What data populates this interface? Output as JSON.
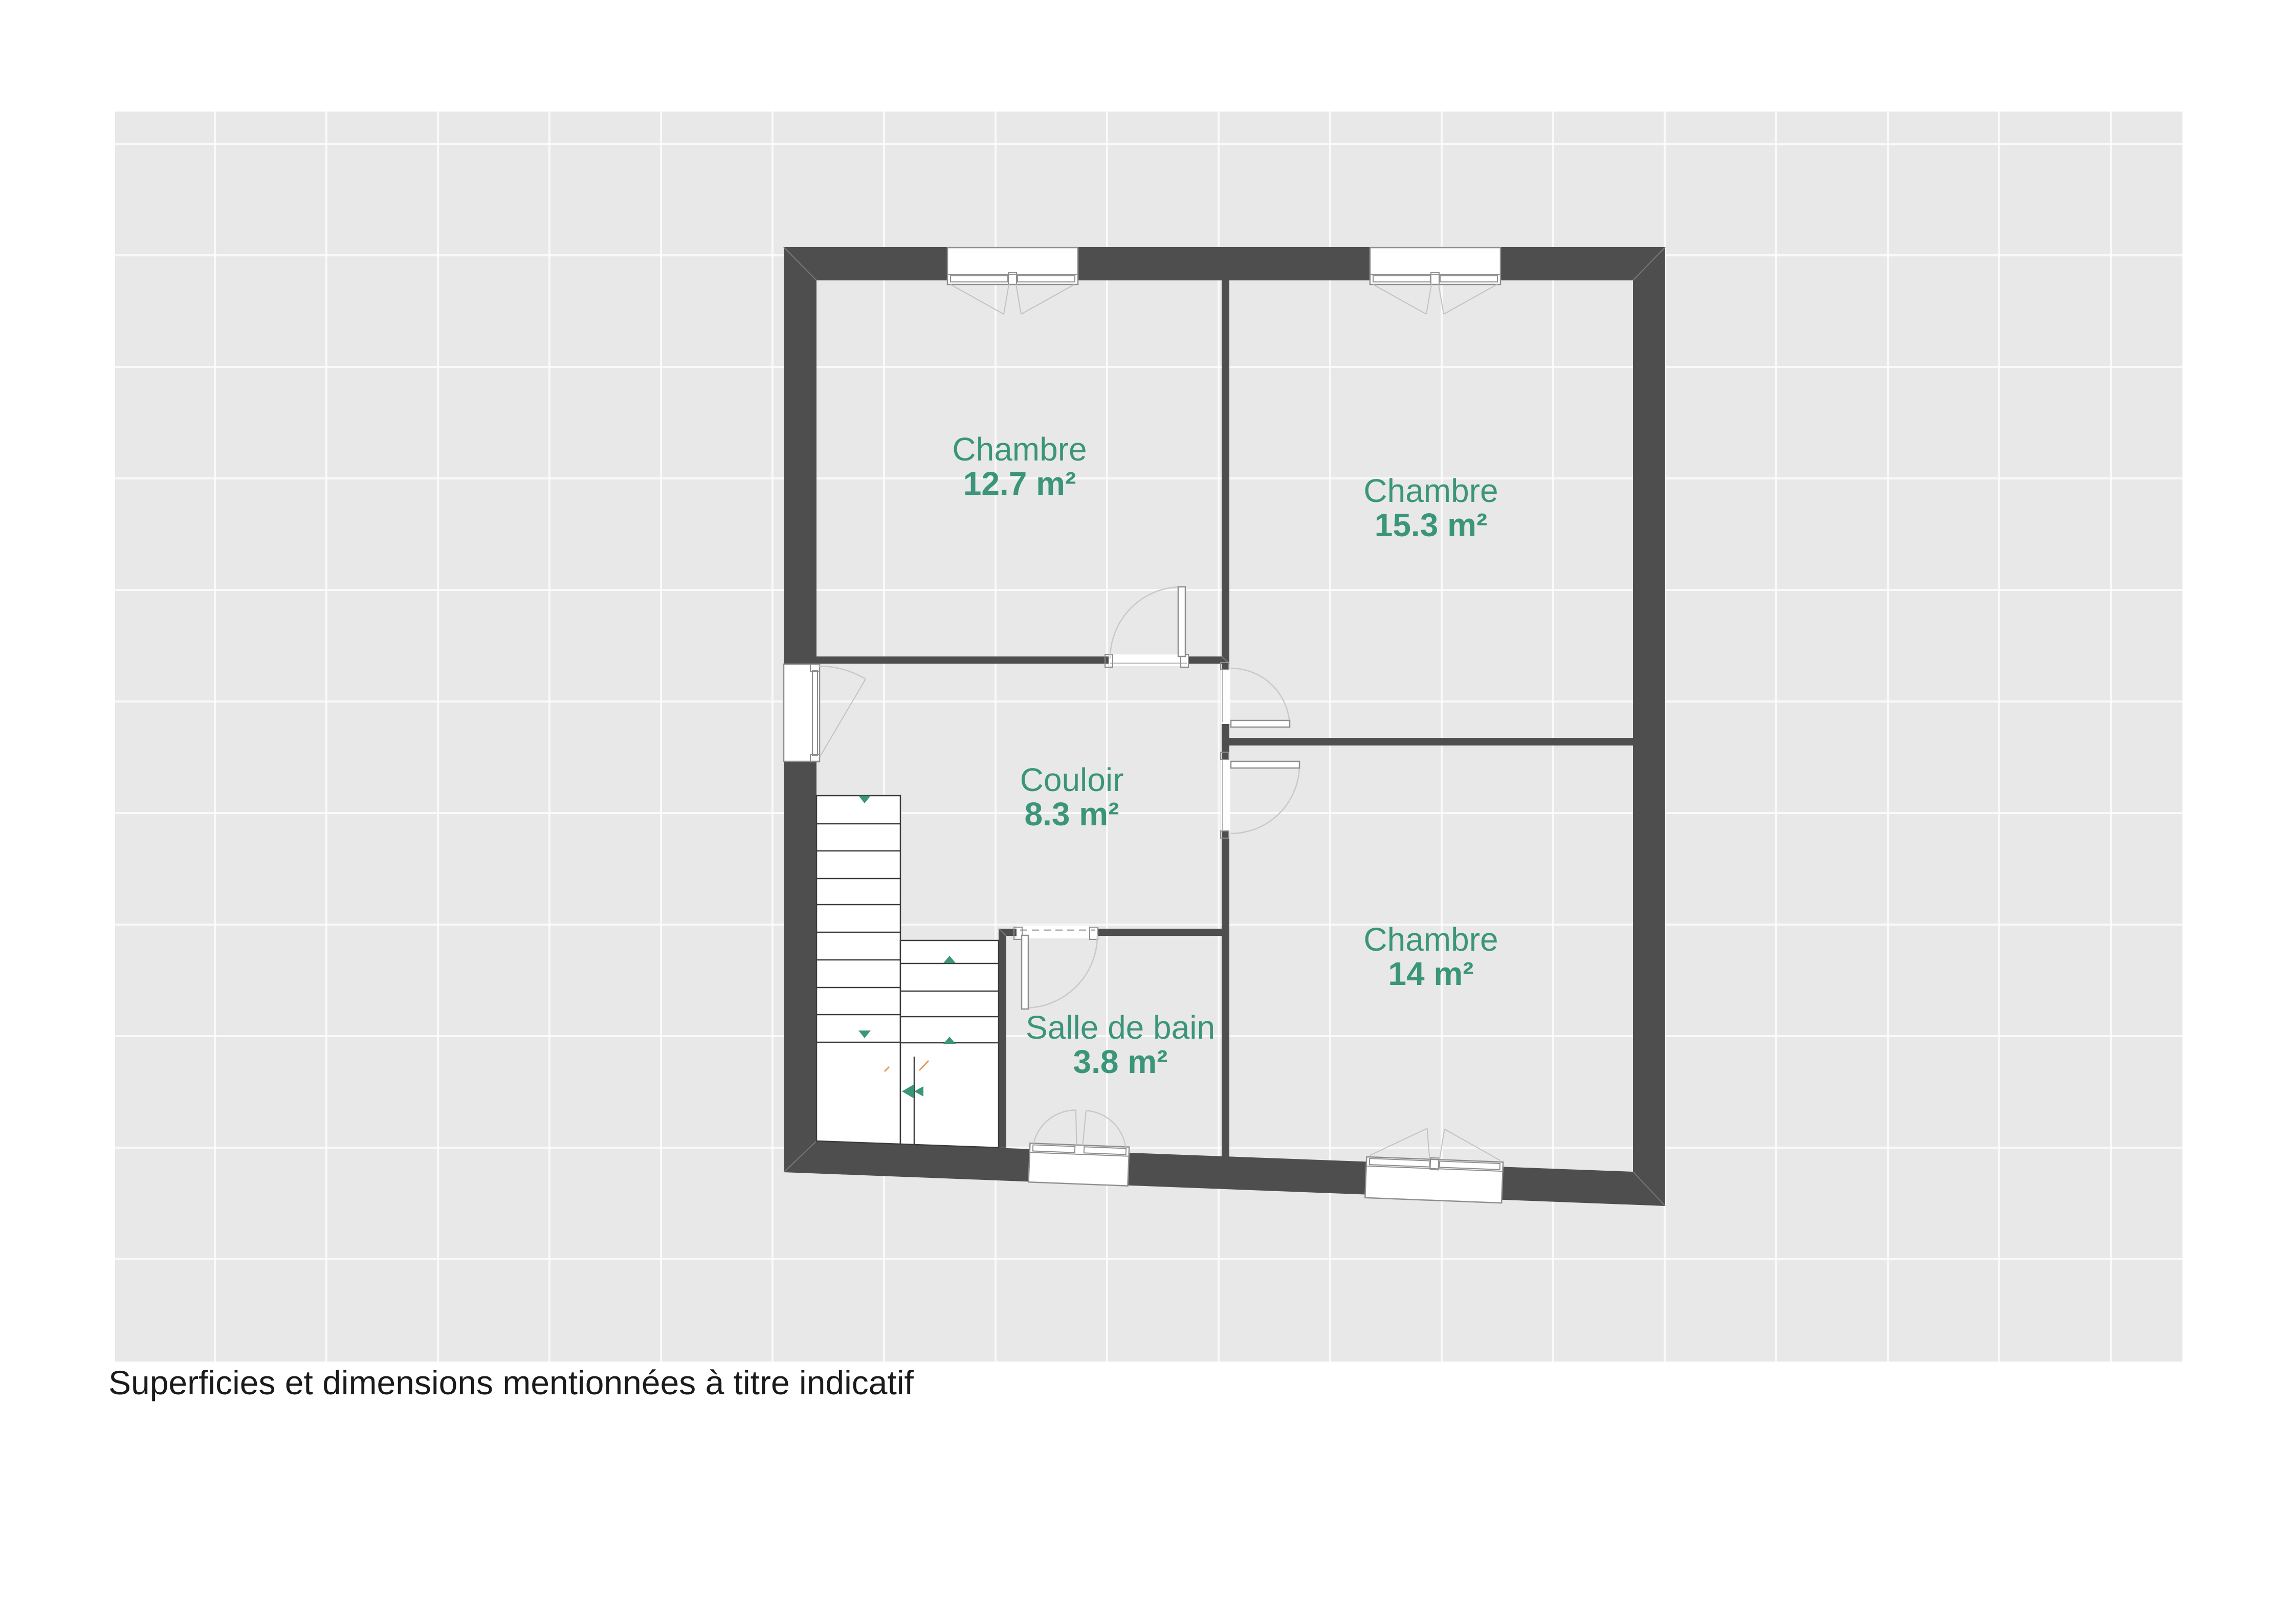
{
  "plan": {
    "caption": "Superficies et dimensions mentionnées à titre indicatif",
    "rooms": [
      {
        "name": "Chambre",
        "area": "12.7 m²"
      },
      {
        "name": "Chambre",
        "area": "15.3 m²"
      },
      {
        "name": "Couloir",
        "area": "8.3 m²"
      },
      {
        "name": "Chambre",
        "area": "14 m²"
      },
      {
        "name": "Salle de bain",
        "area": "3.8 m²"
      }
    ]
  },
  "colors": {
    "wall": "#4e4e4e",
    "room_label": "#3b9579",
    "caption_text": "#1a1a1a",
    "grid_panel": "#e8e8e8",
    "stair_arrow": "#3b9579",
    "accent_tick": "#e59a57"
  }
}
